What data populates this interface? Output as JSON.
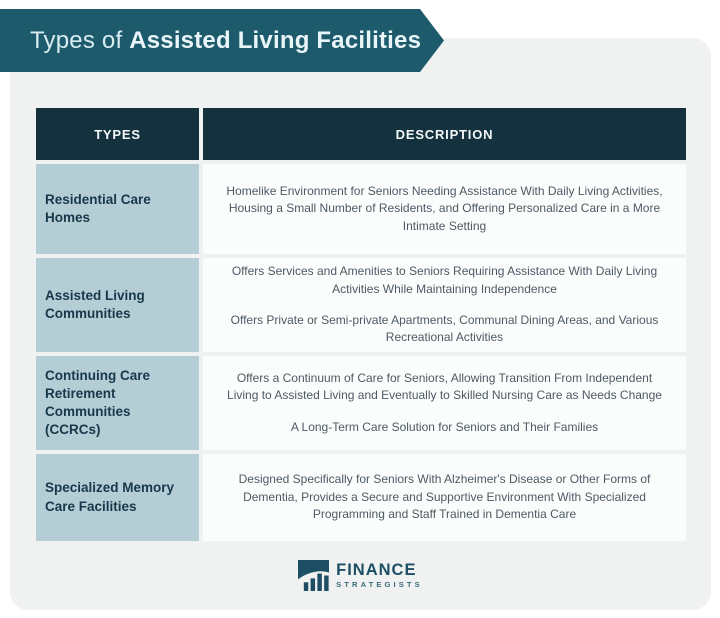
{
  "banner": {
    "title_prefix": "Types of ",
    "title_bold": "Assisted Living Facilities"
  },
  "table": {
    "headers": [
      {
        "label": "TYPES"
      },
      {
        "label": "DESCRIPTION"
      }
    ],
    "rows": [
      {
        "type": "Residential Care Homes",
        "descriptions": [
          "Homelike Environment for Seniors Needing Assistance With Daily Living Activities, Housing a Small Number of Residents, and Offering Personalized Care in a More Intimate Setting"
        ]
      },
      {
        "type": "Assisted Living Communities",
        "descriptions": [
          "Offers Services and Amenities to Seniors Requiring Assistance With Daily Living Activities While Maintaining Independence",
          "Offers Private or Semi-private Apartments, Communal Dining Areas, and Various Recreational Activities"
        ]
      },
      {
        "type": "Continuing Care Retirement Communities (CCRCs)",
        "descriptions": [
          "Offers a Continuum of Care for Seniors, Allowing Transition From Independent Living to Assisted Living and Eventually to Skilled Nursing Care as Needs Change",
          "A Long-Term Care Solution for Seniors and Their Families"
        ]
      },
      {
        "type": "Specialized Memory Care Facilities",
        "descriptions": [
          "Designed Specifically for Seniors With Alzheimer's Disease or Other Forms of Dementia, Provides a Secure and Supportive Environment With Specialized Programming and Staff Trained in Dementia Care"
        ]
      }
    ]
  },
  "footer": {
    "brand_name": "FINANCE",
    "brand_subname": "STRATEGISTS",
    "logo_icon": "bar-chart-swoosh-icon"
  },
  "colors": {
    "banner_teal": "#1d5b6c",
    "header_dark": "#13323d",
    "type_cell_blue": "#b5cdd5",
    "card_gray": "#f0f1f1",
    "desc_cell_white": "#fbfcfc",
    "type_text": "#17384a",
    "desc_text": "#4d5a63",
    "brand_dark": "#1d5065"
  }
}
